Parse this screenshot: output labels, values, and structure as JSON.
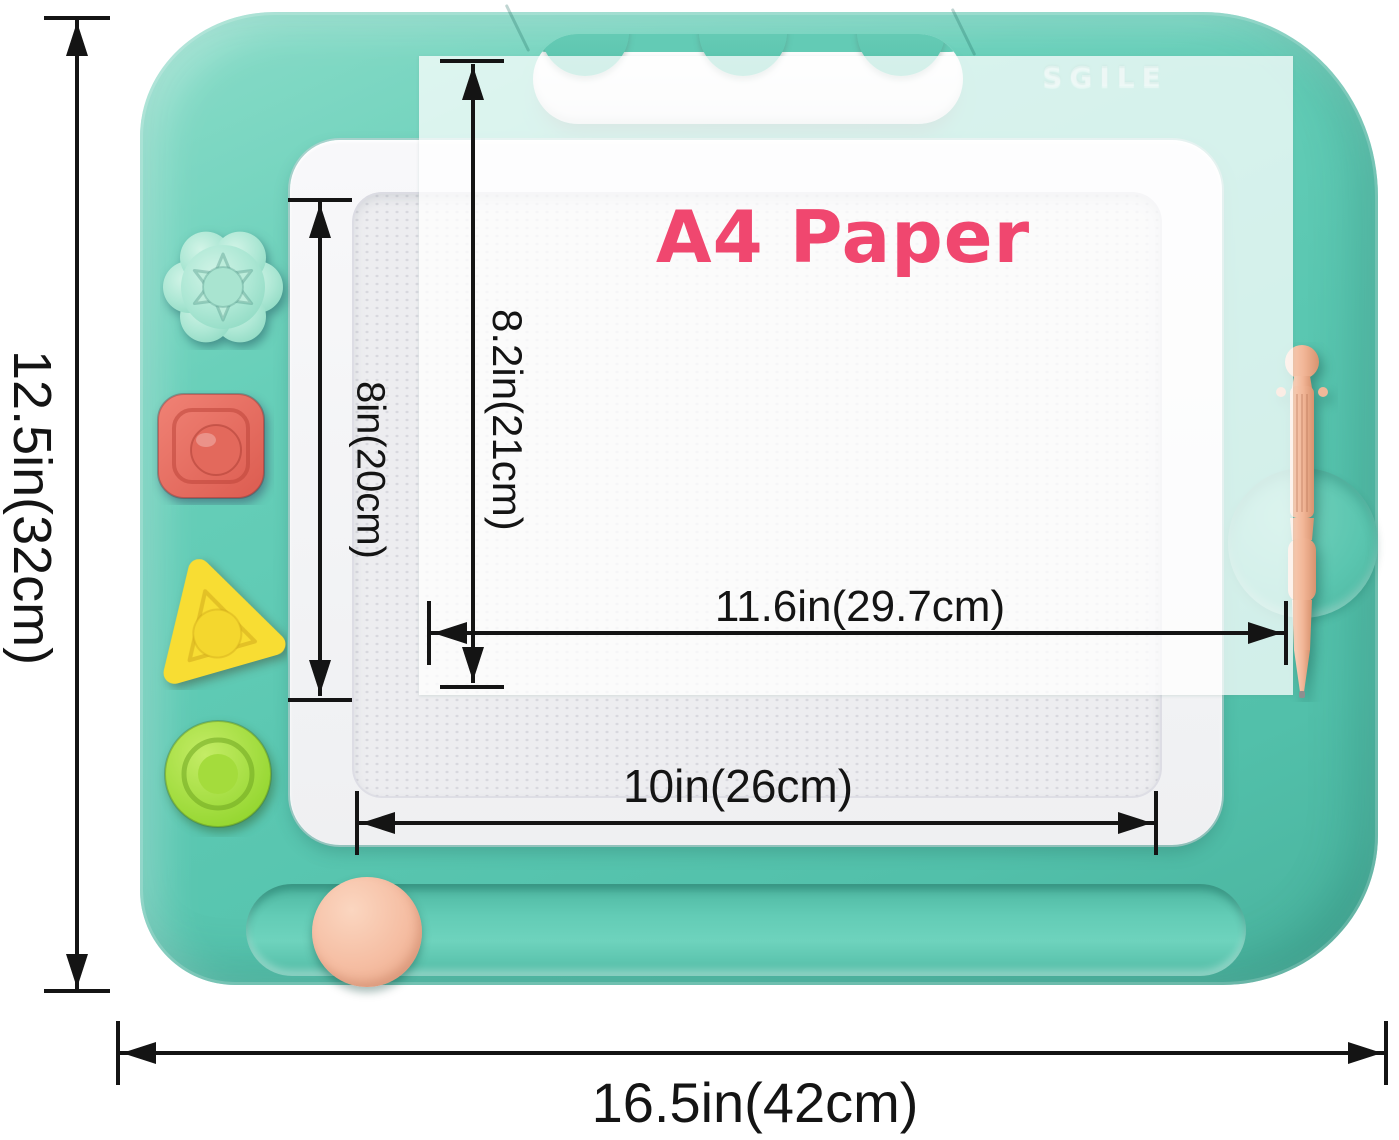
{
  "product": {
    "kind": "magnetic-drawing-board",
    "brand_embossed": "SGILE",
    "colors": {
      "board_body": "#5CC9B3",
      "screen_frame": "#F4F4F6",
      "drawing_surface": "#EDEDF0",
      "paper_title": "#F0476F",
      "annotation": "#141414",
      "pen": "#F2B697",
      "slider_knob": "#F5BDA2"
    }
  },
  "stamps": [
    {
      "shape": "flower",
      "color": "#ACE7D4"
    },
    {
      "shape": "square",
      "color": "#E4675B"
    },
    {
      "shape": "triangle",
      "color": "#F8DD33"
    },
    {
      "shape": "circle",
      "color": "#9EDA33"
    }
  ],
  "dimensions": {
    "board": {
      "height": "12.5in(32cm)",
      "width": "16.5in(42cm)"
    },
    "drawing_area": {
      "height": "8in(20cm)",
      "width": "10in(26cm)"
    },
    "a4_paper": {
      "title": "A4 Paper",
      "height": "8.2in(21cm)",
      "width": "11.6in(29.7cm)"
    }
  }
}
